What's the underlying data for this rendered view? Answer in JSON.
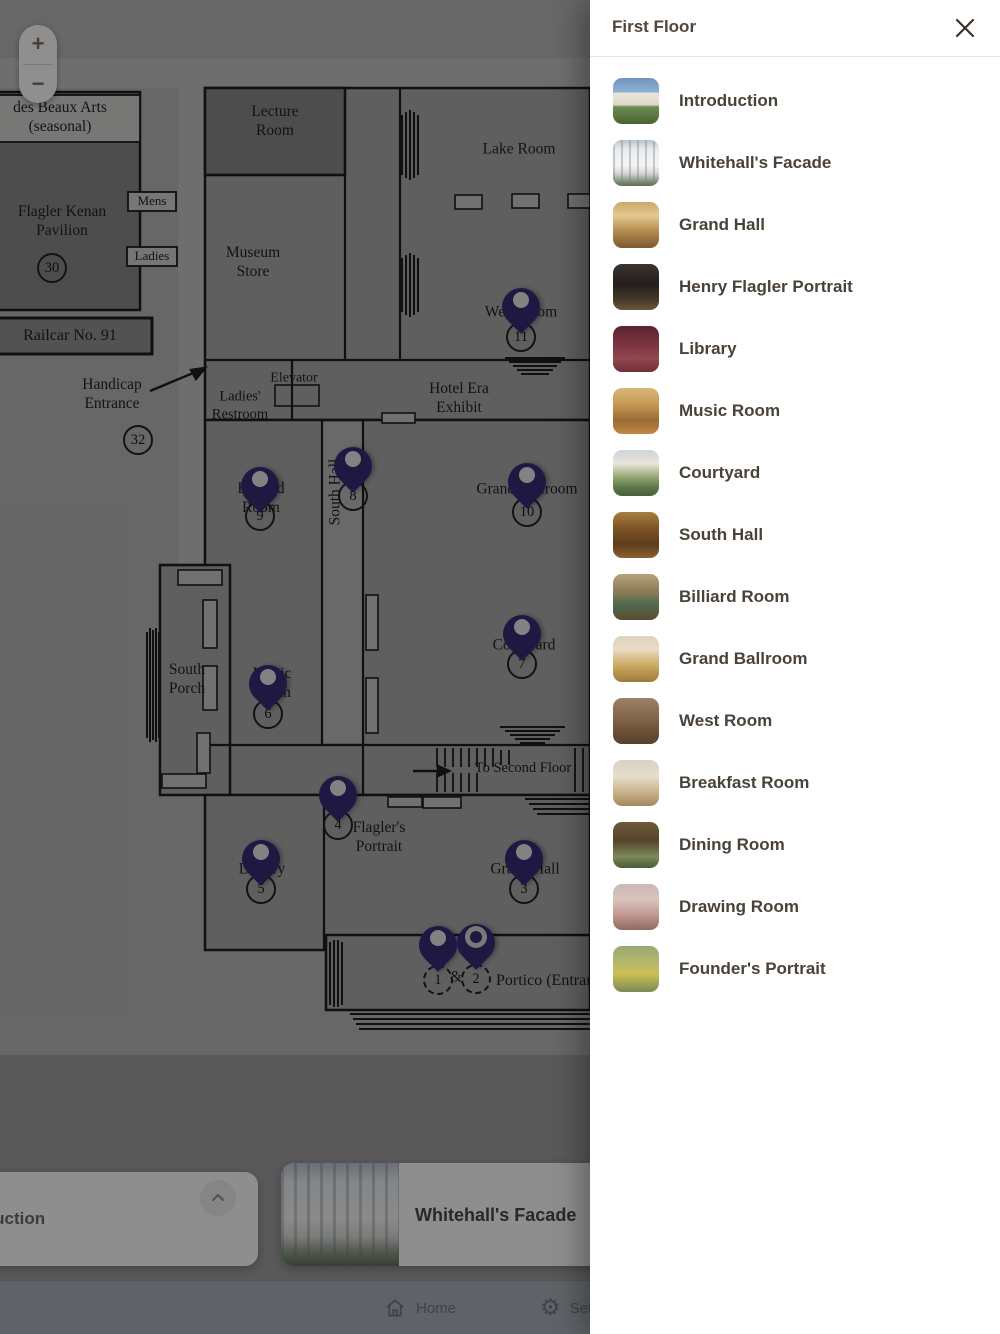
{
  "panel": {
    "title": "First Floor",
    "rooms": [
      {
        "name": "Introduction"
      },
      {
        "name": "Whitehall's Facade"
      },
      {
        "name": "Grand Hall"
      },
      {
        "name": "Henry Flagler Portrait"
      },
      {
        "name": "Library"
      },
      {
        "name": "Music Room"
      },
      {
        "name": "Courtyard"
      },
      {
        "name": "South Hall"
      },
      {
        "name": "Billiard Room"
      },
      {
        "name": "Grand Ballroom"
      },
      {
        "name": "West Room"
      },
      {
        "name": "Breakfast Room"
      },
      {
        "name": "Dining Room"
      },
      {
        "name": "Drawing Room"
      },
      {
        "name": "Founder's Portrait"
      }
    ]
  },
  "map": {
    "zoom_in": "+",
    "zoom_out": "−",
    "labels": {
      "beaux_arts": "des Beaux Arts\n(seasonal)",
      "lecture_room": "Lecture\nRoom",
      "lake_room": "Lake Room",
      "flagler_kenan_pavilion": "Flagler Kenan\nPavilion",
      "mens": "Mens",
      "ladies": "Ladies",
      "museum_store": "Museum\nStore",
      "railcar": "Railcar No. 91",
      "handicap_entrance": "Handicap\nEntrance",
      "elevator": "Elevator",
      "ladies_restroom": "Ladies'\nRestroom",
      "hotel_era_exhibit": "Hotel Era\nExhibit",
      "west_room": "West Room",
      "south_hall": "South Hall",
      "billiard_room": "Billiard\nRoom",
      "grand_ballroom": "Grand Ballroom",
      "south_porch": "South\nPorch",
      "music_room": "Music\nRoom",
      "courtyard": "Courtyard",
      "to_second_floor": "To Second Floor",
      "flaglers_portrait": "Flagler's\nPortrait",
      "library": "Library",
      "grand_hall": "Grand Hall",
      "portico": "Portico (Entrance)",
      "ampersand": "&"
    },
    "stops": {
      "s1": "1",
      "s2": "2",
      "s3": "3",
      "s4": "4",
      "s5": "5",
      "s6": "6",
      "s7": "7",
      "s8": "8",
      "s9": "9",
      "s10": "10",
      "s11": "11",
      "s30": "30",
      "s32": "32"
    }
  },
  "bottom": {
    "intro_card_label": "Introduction",
    "facade_card_label": "Whitehall's Facade"
  },
  "nav": {
    "home_label": "Home",
    "settings_label": "Settings"
  },
  "colors": {
    "pin": "#2e2770",
    "accent_brown": "#51453c"
  }
}
